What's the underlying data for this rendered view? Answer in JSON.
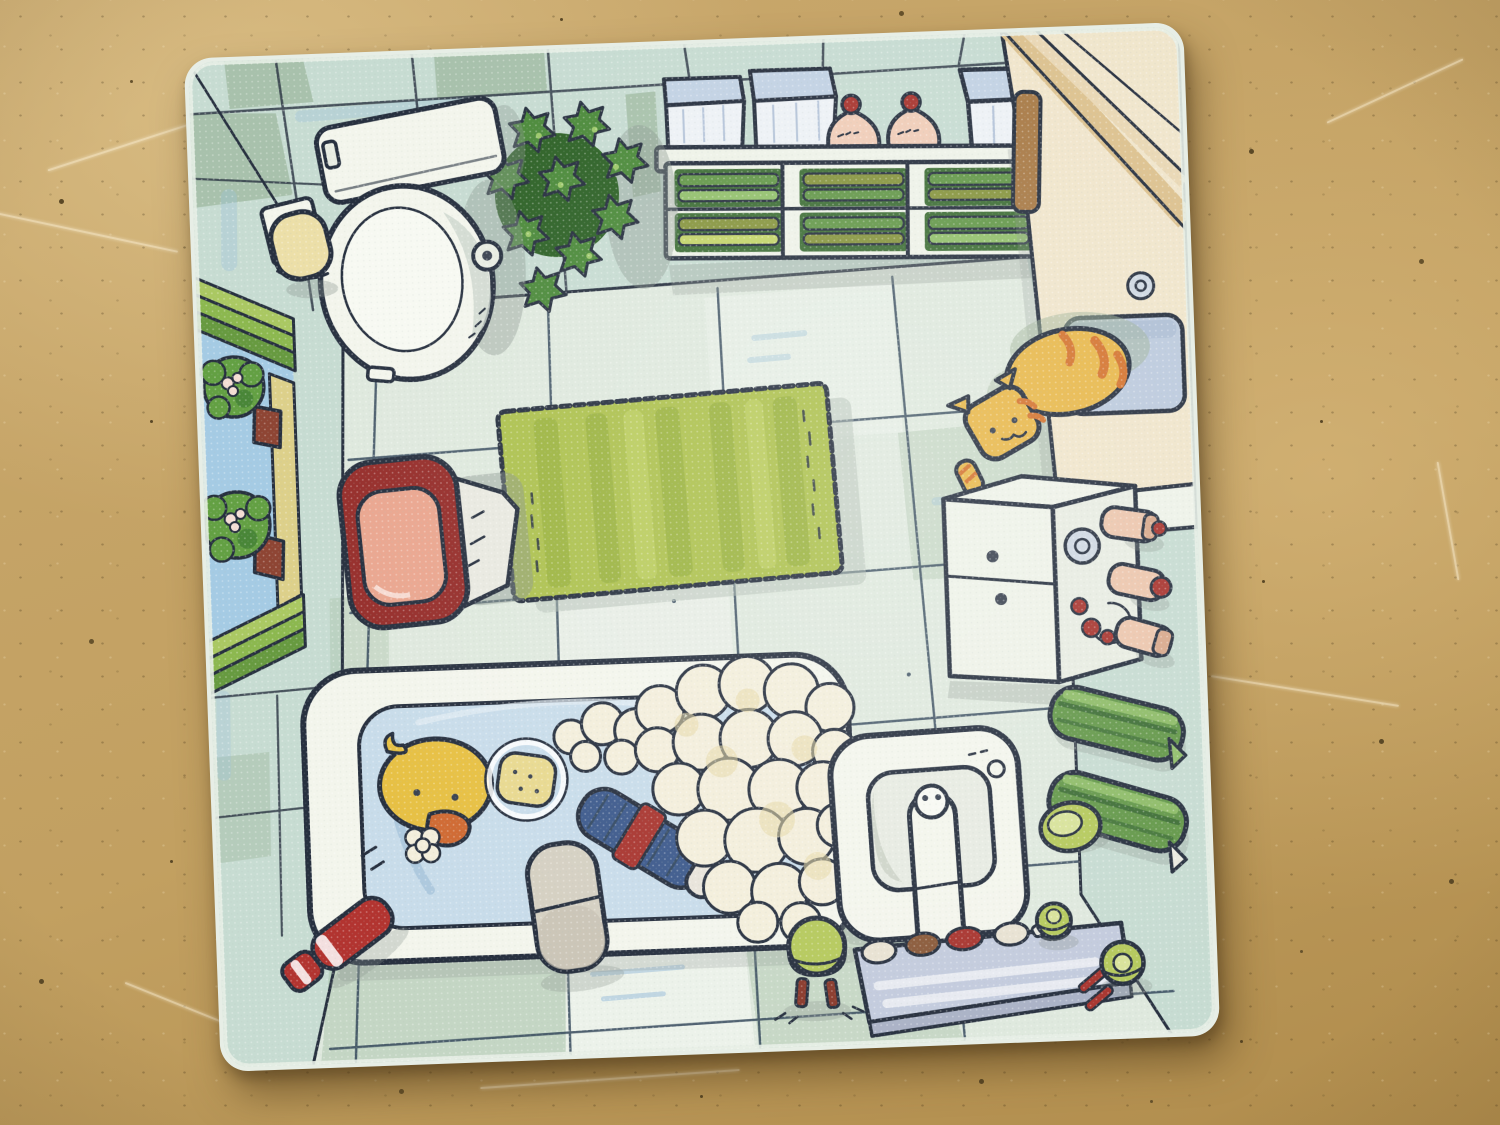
{
  "scene": {
    "type": "photograph",
    "subject": "Square cartoon game tile showing a top-down view of a bathroom, lying on a beige speckled table",
    "tile_rotation_deg": -2.1,
    "objects": [
      {
        "id": "toilet",
        "label": "white toilet with tank and open oval bowl"
      },
      {
        "id": "toilet-paper",
        "label": "toilet paper roll on wall holder"
      },
      {
        "id": "potted-plant",
        "label": "leafy green plant beside the toilet"
      },
      {
        "id": "wall-shelf",
        "label": "white shelf with blue storage boxes, two pink laundry bags and six stacks of green towels"
      },
      {
        "id": "counter",
        "label": "beige counter in top-right corner with inset blue sink and drain"
      },
      {
        "id": "cat",
        "label": "orange tabby cat lying on the counter edge"
      },
      {
        "id": "window",
        "label": "window on left wall with green shutter slats, blue sky and two flowering plants in pots"
      },
      {
        "id": "laundry-bin",
        "label": "red round laundry bin with liner bag"
      },
      {
        "id": "bath-rug",
        "label": "green fluffy bath rug in room center"
      },
      {
        "id": "cabinet",
        "label": "white cabinet with drawers, jar and pink cosmetic bottles"
      },
      {
        "id": "towel-rolls",
        "label": "two rolled green towels on right-wall rails"
      },
      {
        "id": "bathtub",
        "label": "bathtub full of blue water and foam"
      },
      {
        "id": "rubber-duck",
        "label": "yellow rubber duck in the tub"
      },
      {
        "id": "sponge",
        "label": "yellow sponge inside a bubble ring"
      },
      {
        "id": "scrub-brush",
        "label": "blue scrub brush with red grip floating in tub"
      },
      {
        "id": "slipper",
        "label": "grey slipper hanging over the tub edge"
      },
      {
        "id": "toothpaste",
        "label": "red toothpaste tube on the floor"
      },
      {
        "id": "sink",
        "label": "white washbasin with faucet and drain"
      },
      {
        "id": "soap-dish",
        "label": "green soap dish beside the sink"
      },
      {
        "id": "glass-shelf",
        "label": "glass shelf with toothbrush cups below the sink"
      },
      {
        "id": "step-stool",
        "label": "green step stool with red legs"
      },
      {
        "id": "toothbrush-cup",
        "label": "green cup with red toothbrushes"
      },
      {
        "id": "soap-pump",
        "label": "small green soap pump near right wall"
      }
    ]
  },
  "palette": {
    "ink": "#27303f",
    "tileEdge": "#e7eee6",
    "wall": "#c7dcd2",
    "wallDark": "#9eb89f",
    "wallShade": "#8a958f",
    "blueStreak": "#9cc0da",
    "floor": "#dfe9de",
    "floorWhite": "#eef3ec",
    "floorSage": "#aac3a9",
    "floorLine": "#33475a",
    "white": "#f3f5ec",
    "whiteShade": "#ccd6cd",
    "porcelain": "#f7f9f2",
    "fixture2": "#e8ece2",
    "sky": "#a5cbe4",
    "frameLight": "#aac862",
    "frameMid": "#8cb84f",
    "frameDark": "#679a40",
    "sill": "#ddd08a",
    "pot": "#8e4534",
    "bush": "#63a043",
    "bushDark": "#3e7a33",
    "flower": "#f4ddd4",
    "rollCream": "#ecdfa8",
    "plant": "#4c8a3b",
    "plantDark": "#2e6227",
    "plantLight": "#9cc86a",
    "shelfWhite": "#eef2e8",
    "boxBlue": "#c2d2e4",
    "boxBlueDark": "#90a7c6",
    "boxFront": "#edf1f5",
    "bagPink": "#f0cdb8",
    "knotRed": "#a8352f",
    "towel": "#64984a",
    "towelDark": "#3f6f37",
    "towelLight": "#92c06c",
    "towelOlive": "#87953f",
    "counterCream": "#f0e5cb",
    "counterTan": "#dcc18e",
    "counterTan2": "#e9d7b4",
    "counterBrown": "#a87a46",
    "cat": "#e8b84b",
    "catStripe": "#d4742f",
    "catShadow": "#9fb49a",
    "insetSink": "#bccadd",
    "insetDark": "#a9bbd2",
    "sinkGreen": "#8aa84a",
    "water": "#c8dcea",
    "waterDark": "#9dbdd6",
    "waterLight": "#e2ecf4",
    "foam": "#f3eedb",
    "foamShade": "#e7d9a8",
    "duck": "#e7c043",
    "beak": "#cf6a33",
    "sponge": "#e8d98f",
    "brushBlue": "#3d5a8c",
    "brushTip": "#e8e4da",
    "rug": "#adc14e",
    "rugDark": "#99b13f",
    "rugLight": "#c3d46a",
    "rugShadow": "#b2bdb3",
    "binRed": "#962e2b",
    "binPink": "#eaa68f",
    "bagWhite": "#e9e9e0",
    "red": "#b23430",
    "slipper": "#d5d0c2",
    "slipperDark": "#c6c1b2",
    "glass": "#c3cbdd",
    "glassEdge": "#aab2c6",
    "glassSheen": "#ffffff",
    "stool": "#b5c95c",
    "stoolLight": "#d8e29a",
    "legRed": "#8a3a2c",
    "bottlePink": "#ecc6ad",
    "bottleCap": "#d8a98c",
    "brown": "#8a5a3a",
    "cream": "#e8e2d2",
    "knob": "#3a4250",
    "drainGray": "#cfd8e2",
    "basin": "#e7ebe2",
    "basinShade": "#c9cfc4"
  }
}
